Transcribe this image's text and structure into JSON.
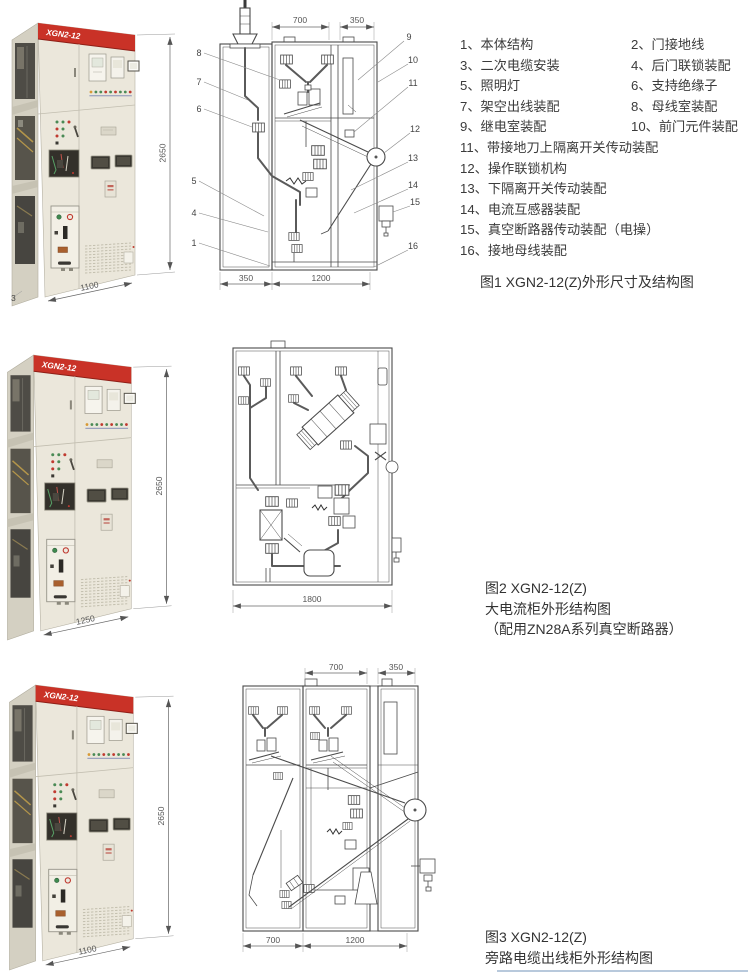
{
  "colors": {
    "band_red": "#c93227",
    "cabinet_body": "#ebe7db",
    "cabinet_side": "#d4d0c2",
    "drawing_line": "#4a4a4a",
    "dim_text": "#555555"
  },
  "figures": {
    "fig1": {
      "cabinet": {
        "model": "XGN2-12",
        "height": "2650",
        "width": "1100",
        "corner_label": "3"
      },
      "diagram": {
        "top_dims": [
          "700",
          "350"
        ],
        "bottom_dims": [
          "350",
          "1200"
        ],
        "callouts_left": [
          "8",
          "7",
          "6",
          "5",
          "4",
          "1"
        ],
        "callouts_right": [
          "9",
          "10",
          "11",
          "12",
          "13",
          "14",
          "15",
          "16"
        ]
      },
      "parts": [
        [
          "1、本体结构",
          "2、门接地线"
        ],
        [
          "3、二次电缆安装",
          "4、后门联锁装配"
        ],
        [
          "5、照明灯",
          "6、支持绝缘子"
        ],
        [
          "7、架空出线装配",
          "8、母线室装配"
        ],
        [
          "9、继电室装配",
          "10、前门元件装配"
        ]
      ],
      "parts_single": [
        "11、带接地刀上隔离开关传动装配",
        "12、操作联锁机构",
        "13、下隔离开关传动装配",
        "14、电流互感器装配",
        "15、真空断路器传动装配（电操）",
        "16、接地母线装配"
      ],
      "caption": "图1 XGN2-12(Z)外形尺寸及结构图"
    },
    "fig2": {
      "cabinet": {
        "model": "XGN2-12",
        "height": "2650",
        "width": "1250"
      },
      "diagram": {
        "bottom_dims": [
          "1800"
        ]
      },
      "caption_lines": [
        "图2 XGN2-12(Z)",
        "大电流柜外形结构图",
        "（配用ZN28A系列真空断路器）"
      ]
    },
    "fig3": {
      "cabinet": {
        "model": "XGN2-12",
        "height": "2650",
        "width": "1100"
      },
      "diagram": {
        "top_dims": [
          "700",
          "350"
        ],
        "bottom_dims": [
          "700",
          "1200"
        ]
      },
      "caption_lines": [
        "图3 XGN2-12(Z)",
        "旁路电缆出线柜外形结构图"
      ]
    }
  }
}
